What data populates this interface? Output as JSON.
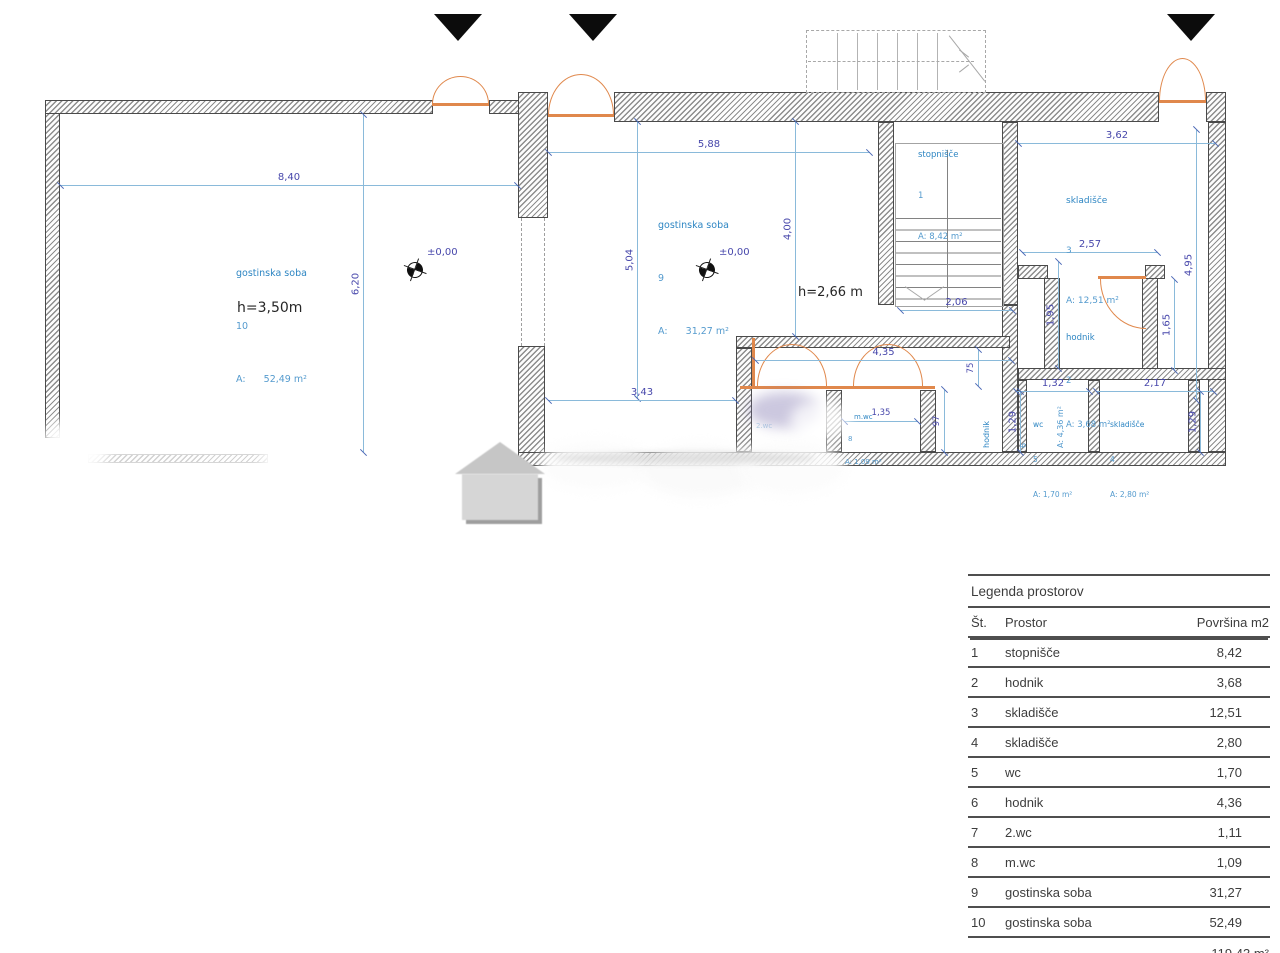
{
  "plan": {
    "rooms": {
      "r10": {
        "name": "gostinska soba",
        "num": "10",
        "area": "A:      52,49 m²"
      },
      "r9": {
        "name": "gostinska soba",
        "num": "9",
        "area": "A:      31,27 m²"
      },
      "r1": {
        "name": "stopnišče",
        "num": "1",
        "area": "A: 8,42 m²"
      },
      "r3": {
        "name": "skladišče",
        "num": "3",
        "area": "A: 12,51 m²"
      },
      "r2": {
        "name": "hodnik",
        "num": "2",
        "area": "A: 3,68 m²"
      },
      "r5": {
        "name": "wc",
        "num": "5",
        "area": "A: 1,70 m²"
      },
      "r4": {
        "name": "skladišče",
        "num": "4",
        "area": "A: 2,80 m²"
      },
      "r8": {
        "name": "m.wc",
        "num": "8",
        "area": "A: 1,09 m²"
      },
      "r7": {
        "name": "2.wc"
      },
      "r6": {
        "name": "hodnik",
        "num": "6",
        "area": "A: 4,36 m²"
      }
    },
    "markers": {
      "level1": "±0,00",
      "level2": "±0,00",
      "height_left": "h=3,50m",
      "height_mid": "h=2,66 m"
    },
    "dims": {
      "w840": "8,40",
      "h620": "6,20",
      "w588": "5,88",
      "h504": "5,04",
      "h400": "4,00",
      "w343": "3,43",
      "w435": "4,35",
      "w206": "2,06",
      "w362": "3,62",
      "w257": "2,57",
      "h495": "4,95",
      "h195": "1,95",
      "h165": "1,65",
      "w132": "1,32",
      "w217": "2,17",
      "h129a": "1,29",
      "h129b": "1,29",
      "w135": "1,35",
      "h75": "75",
      "h97": "97"
    },
    "colors": {
      "dimension": "#4747ab",
      "room_label": "#2e86c3",
      "door": "#e0884c"
    }
  },
  "legend": {
    "title": "Legenda prostorov",
    "columns": [
      "Št.",
      "Prostor",
      "Površina m2"
    ],
    "rows": [
      {
        "n": "1",
        "name": "stopnišče",
        "val": "8,42"
      },
      {
        "n": "2",
        "name": "hodnik",
        "val": "3,68"
      },
      {
        "n": "3",
        "name": "skladišče",
        "val": "12,51"
      },
      {
        "n": "4",
        "name": "skladišče",
        "val": "2,80"
      },
      {
        "n": "5",
        "name": "wc",
        "val": "1,70"
      },
      {
        "n": "6",
        "name": "hodnik",
        "val": "4,36"
      },
      {
        "n": "7",
        "name": "2.wc",
        "val": "1,11"
      },
      {
        "n": "8",
        "name": "m.wc",
        "val": "1,09"
      },
      {
        "n": "9",
        "name": "gostinska soba",
        "val": "31,27"
      },
      {
        "n": "10",
        "name": "gostinska soba",
        "val": "52,49"
      }
    ],
    "total": "119,43 m²"
  }
}
